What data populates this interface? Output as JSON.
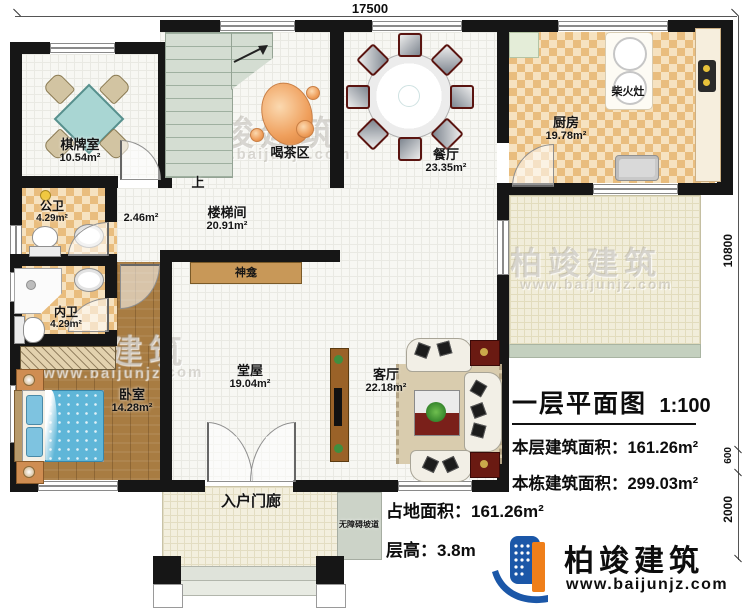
{
  "plan": {
    "labels": {
      "qipaishi_name": "棋牌室",
      "qipaishi_area": "10.54m²",
      "hechaqu_name": "喝茶区",
      "canting_name": "餐厅",
      "canting_area": "23.35m²",
      "chufang_name": "厨房",
      "chufang_area": "19.78m²",
      "chaihuozao_name": "柴火灶",
      "gongwei_name": "公卫",
      "gongwei_area": "4.29m²",
      "neiwei_name": "内卫",
      "neiwei_area": "4.29m²",
      "loutijian_name": "楼梯间",
      "loutijian_area": "20.91m²",
      "nook_area": "2.46m²",
      "up_label": "上",
      "shenkan_name": "神龛",
      "woshi_name": "卧室",
      "woshi_area": "14.28m²",
      "tangwu_name": "堂屋",
      "tangwu_area": "19.04m²",
      "keting_name": "客厅",
      "keting_area": "22.18m²",
      "menlang_name": "入户门廊",
      "podao_name": "无障碍坡道"
    },
    "dimensions": {
      "top_width": "17500",
      "right_main": "10800",
      "right_porch": "600",
      "right_steps": "2000"
    }
  },
  "titleblock": {
    "title": "一层平面图",
    "scale": "1:100",
    "floor_area_label": "本层建筑面积：",
    "floor_area_value": "161.26m²",
    "total_area_label": "本栋建筑面积：",
    "total_area_value": "299.03m²",
    "footprint_label": "占地面积：",
    "footprint_value": "161.26m²",
    "height_label": "层高：",
    "height_value": "3.8m"
  },
  "brand": {
    "name": "柏竣建筑",
    "website": "www.baijunjz.com"
  },
  "colors": {
    "wall": "#161616",
    "kitchen_tile": "#e9bd7e",
    "wood_floor": "#a87c42",
    "patio": "#f1edda",
    "logo_blue": "#1b57a8",
    "logo_orange": "#ef7f1a",
    "table_teal": "#a9d6d3",
    "bed_blue": "#5fb6d8",
    "rug_red": "#7a201a"
  }
}
